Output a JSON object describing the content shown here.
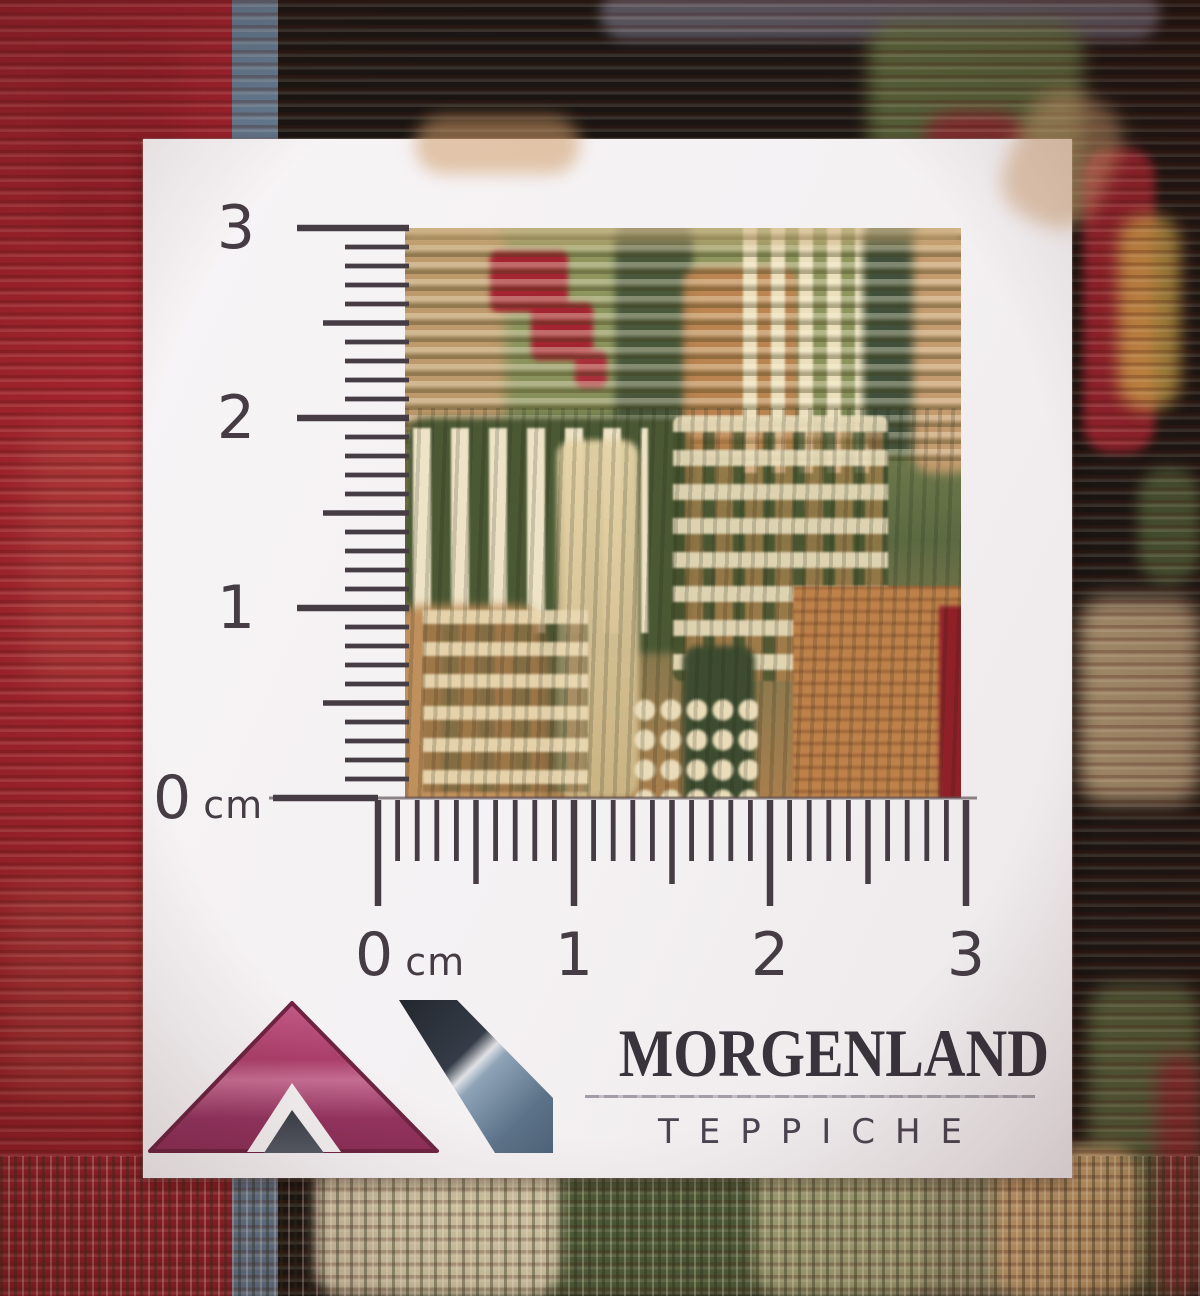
{
  "brand": {
    "name": "MORGENLAND",
    "subtitle": "TEPPICHE"
  },
  "rulers": {
    "vertical": {
      "labels": [
        "3",
        "2",
        "1",
        "0"
      ],
      "unit": "cm",
      "cm": 3,
      "mm_per_cm": 10
    },
    "horizontal": {
      "labels": [
        "0",
        "1",
        "2",
        "3"
      ],
      "unit": "cm",
      "cm": 3,
      "mm_per_cm": 10
    }
  },
  "colors": {
    "card_white": "#f5f2f3",
    "ruler_ink": "#453c44",
    "brand_ink": "#39333c",
    "logo_pink": "#ab3f6b",
    "logo_navy_dark": "#353c47",
    "logo_navy_light": "#8ea3b7",
    "carpet_red": "#a2232e",
    "carpet_blue_stripe": "#6f87a0",
    "carpet_orange": "#cf8d55",
    "weave_olive": "#8f975f",
    "weave_forest": "#46543a",
    "weave_cream": "#ebdfbd",
    "weave_tan": "#c39a6d",
    "weave_motif_red": "#a32531"
  }
}
